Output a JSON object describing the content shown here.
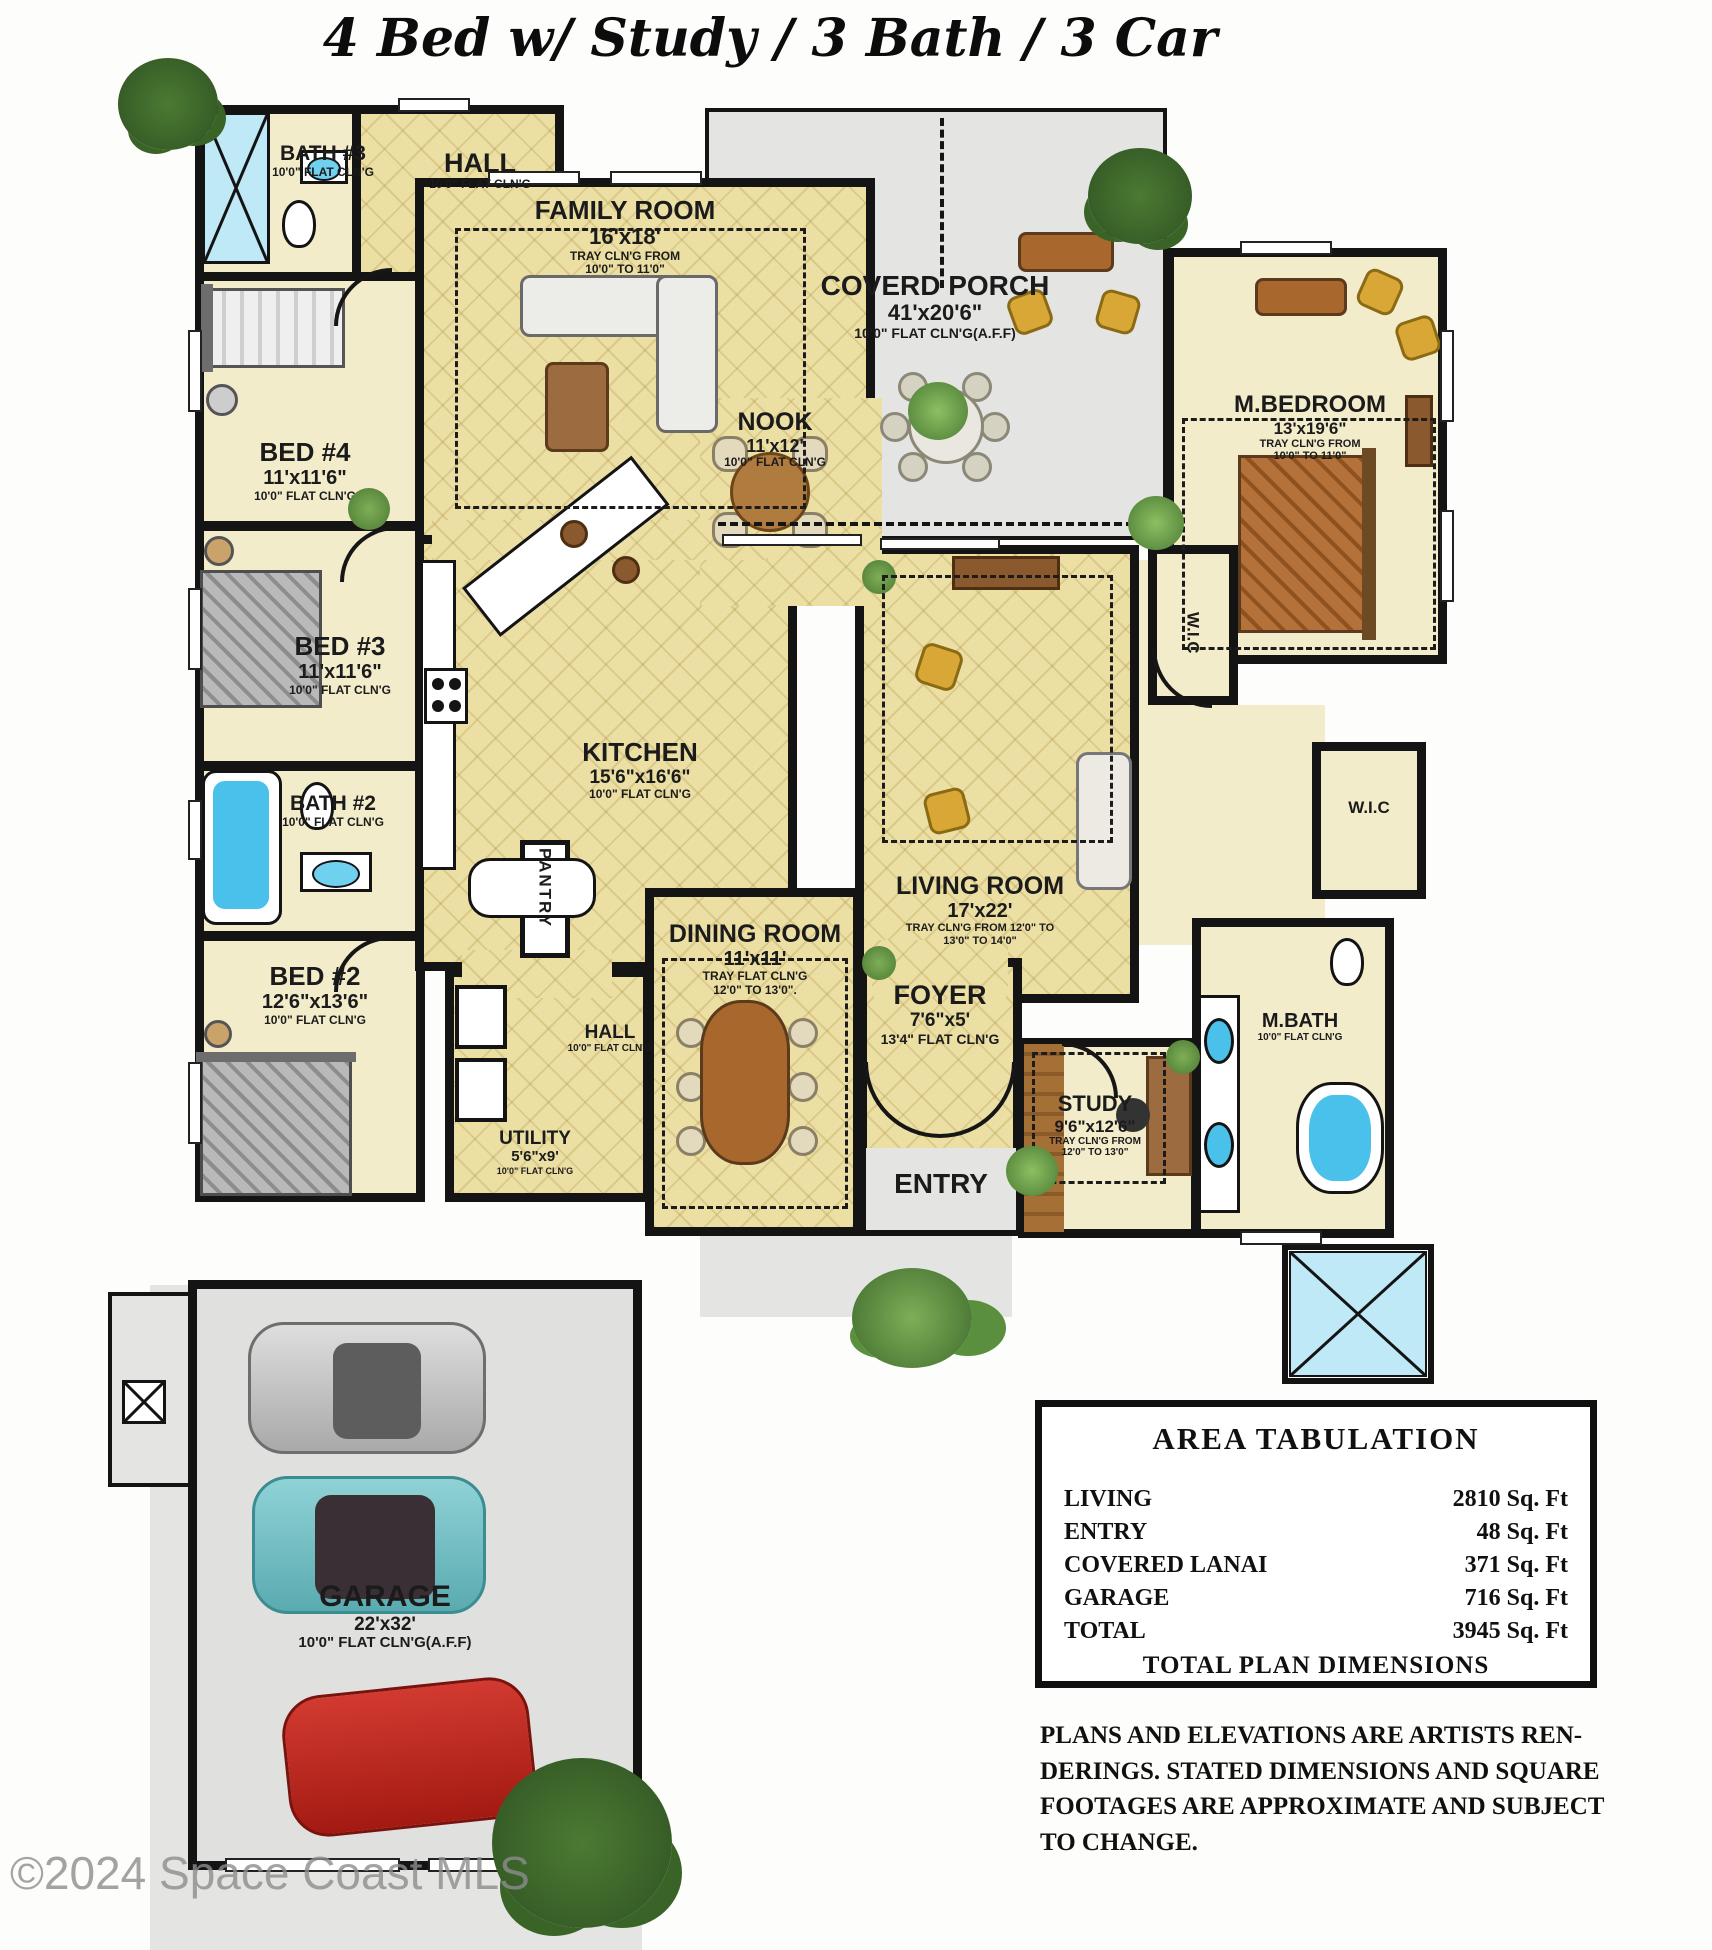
{
  "title": "4 Bed w/ Study / 3 Bath / 3 Car",
  "watermark": "©2024 Space Coast MLS",
  "colors": {
    "wall": "#141414",
    "tile_floor": "#ebdfa4",
    "room_floor": "#f2eccb",
    "porch_concrete": "#e4e4e2",
    "water": "#4ac1ea",
    "tree_green": "#3f6d2e"
  },
  "rooms": {
    "bath3": {
      "name": "BATH #3",
      "ceiling": "10'0\" FLAT CLN'G"
    },
    "hall_top": {
      "name": "HALL",
      "ceiling": "10'0\" FLAT CLN'G"
    },
    "family": {
      "name": "FAMILY ROOM",
      "dims": "16'x18'",
      "ceiling": "TRAY CLN'G FROM 10'0\" TO 11'0\""
    },
    "porch": {
      "name": "COVERD PORCH",
      "dims": "41'x20'6\"",
      "ceiling": "10'0\" FLAT CLN'G(A.F.F)"
    },
    "mbedroom": {
      "name": "M.BEDROOM",
      "dims": "13'x19'6\"",
      "ceiling": "TRAY CLN'G FROM 10'0\" TO 11'0\""
    },
    "bed4": {
      "name": "BED #4",
      "dims": "11'x11'6\"",
      "ceiling": "10'0\" FLAT CLN'G"
    },
    "bed3": {
      "name": "BED #3",
      "dims": "11'x11'6\"",
      "ceiling": "10'0\" FLAT CLN'G"
    },
    "nook": {
      "name": "NOOK",
      "dims": "11'x12'",
      "ceiling": "10'0\" FLAT CLN'G"
    },
    "kitchen": {
      "name": "KITCHEN",
      "dims": "15'6\"x16'6\"",
      "ceiling": "10'0\" FLAT CLN'G"
    },
    "wic1": {
      "name": "W.I.C"
    },
    "wic2": {
      "name": "W.I.C"
    },
    "bath2": {
      "name": "BATH #2",
      "ceiling": "10'0\" FLAT CLN'G"
    },
    "bed2": {
      "name": "BED #2",
      "dims": "12'6\"x13'6\"",
      "ceiling": "10'0\" FLAT CLN'G"
    },
    "living": {
      "name": "LIVING ROOM",
      "dims": "17'x22'",
      "ceiling": "TRAY CLN'G FROM 12'0\" TO 13'0\" TO 14'0\""
    },
    "dining": {
      "name": "DINING ROOM",
      "dims": "11'x11'",
      "ceiling": "TRAY FLAT CLN'G 12'0\" TO 13'0\"."
    },
    "foyer": {
      "name": "FOYER",
      "dims": "7'6\"x5'",
      "ceiling": "13'4\" FLAT CLN'G"
    },
    "study": {
      "name": "STUDY",
      "dims": "9'6\"x12'6\"",
      "ceiling": "TRAY CLN'G FROM 12'0\" TO 13'0\""
    },
    "mbath": {
      "name": "M.BATH",
      "ceiling": "10'0\" FLAT CLN'G"
    },
    "pantry": {
      "name": "PANTRY"
    },
    "hall_lower": {
      "name": "HALL",
      "ceiling": "10'0\" FLAT CLN'G"
    },
    "utility": {
      "name": "UTILITY",
      "dims": "5'6\"x9'",
      "ceiling": "10'0\" FLAT CLN'G"
    },
    "entry": {
      "name": "ENTRY"
    },
    "garage": {
      "name": "GARAGE",
      "dims": "22'x32'",
      "ceiling": "10'0\" FLAT CLN'G(A.F.F)"
    }
  },
  "area_tabulation": {
    "title": "AREA TABULATION",
    "rows": [
      {
        "label": "LIVING",
        "value": "2810 Sq. Ft"
      },
      {
        "label": "ENTRY",
        "value": "48 Sq. Ft"
      },
      {
        "label": "COVERED LANAI",
        "value": "371 Sq. Ft"
      },
      {
        "label": "GARAGE",
        "value": "716 Sq. Ft"
      },
      {
        "label": "TOTAL",
        "value": "3945 Sq. Ft"
      }
    ],
    "footer": "TOTAL PLAN DIMENSIONS"
  },
  "disclaimer": "PLANS AND ELEVATIONS ARE ARTISTS REN- DERINGS. STATED DIMENSIONS AND SQUARE FOOTAGES  ARE APPROXIMATE AND SUBJECT TO CHANGE."
}
